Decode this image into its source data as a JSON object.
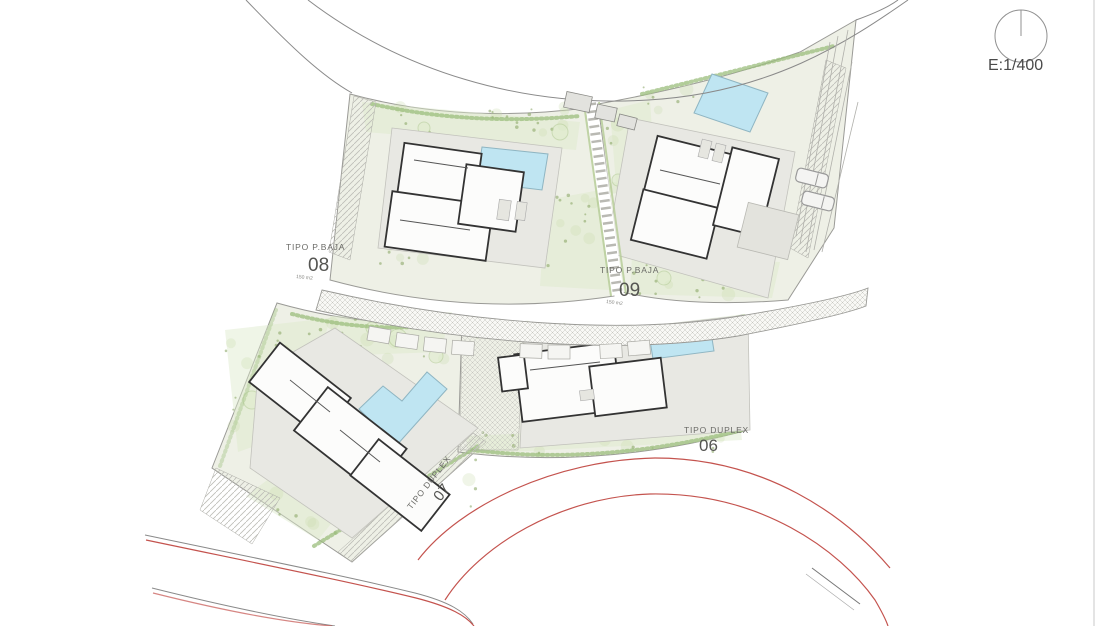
{
  "scale": {
    "label": "E:1/400"
  },
  "plots": [
    {
      "id": "08",
      "type_label": "TIPO P.BAJA",
      "number": "08",
      "area_label": "150 m2"
    },
    {
      "id": "09",
      "type_label": "TIPO P.BAJA",
      "number": "09",
      "area_label": "150 m2"
    },
    {
      "id": "07",
      "type_label": "TIPO DUPLEX",
      "number": "07"
    },
    {
      "id": "06",
      "type_label": "TIPO DUPLEX",
      "number": "06"
    }
  ],
  "icons": {
    "north_indicator": "north-indicator-circle"
  },
  "colors": {
    "pool": "#bfe5f2",
    "pool_border": "#8fb5c2",
    "road_red": "#c4534e",
    "road_gray": "#8a8a8a",
    "plot_fill": "#eef0e6",
    "deck_fill": "#e8e8e3",
    "wall": "#333333",
    "veg_dark": "#85a35f",
    "veg_light": "#c9dcab",
    "veg_mid": "#9bbd7c",
    "text": "#4a4a4a"
  }
}
